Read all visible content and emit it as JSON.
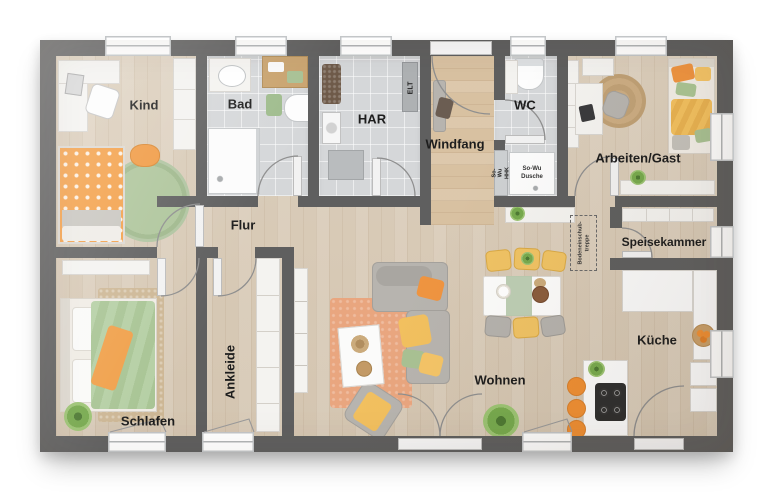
{
  "plan": {
    "rooms": {
      "kind": "Kind",
      "bad": "Bad",
      "har": "HAR",
      "windfang": "Windfang",
      "wc": "WC",
      "arbeiten": "Arbeiten/Gast",
      "speisekammer": "Speisekammer",
      "kueche": "Küche",
      "wohnen": "Wohnen",
      "flur": "Flur",
      "ankleide": "Ankleide",
      "schlafen": "Schlafen"
    },
    "small_labels": {
      "elt": "ELT",
      "so_wu_hhk": {
        "l1": "So-Wu",
        "l2": "HHK"
      },
      "so_wu_dusche": {
        "l1": "So-Wu",
        "l2": "Dusche"
      },
      "bodeneinschubtreppe": {
        "l1": "Bodeneinschub-",
        "l2": "treppe"
      }
    },
    "colors": {
      "wall": "#5f5f5f",
      "wood": "#d9cbb7",
      "entry_wood": "#d8c1a1",
      "tile": "#d5d7d9",
      "accent_orange": "#ef9a42",
      "accent_green": "#a8c194",
      "accent_yellow": "#f2c76e",
      "sofa_gray": "#b7b4af",
      "rug_coral": "#e9a67f"
    }
  }
}
